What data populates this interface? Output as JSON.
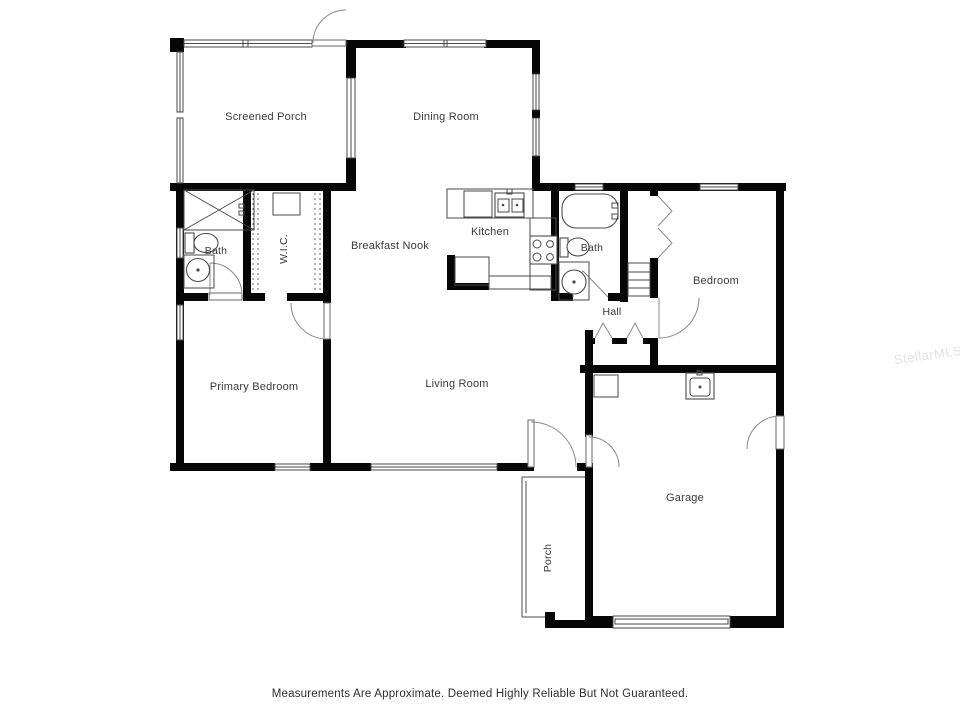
{
  "plan": {
    "rooms": [
      {
        "id": "screened-porch",
        "label": "Screened Porch"
      },
      {
        "id": "dining-room",
        "label": "Dining Room"
      },
      {
        "id": "breakfast-nook",
        "label": "Breakfast Nook"
      },
      {
        "id": "kitchen",
        "label": "Kitchen"
      },
      {
        "id": "bath-1",
        "label": "Bath"
      },
      {
        "id": "wic",
        "label": "W.I.C."
      },
      {
        "id": "bath-2",
        "label": "Bath"
      },
      {
        "id": "bedroom",
        "label": "Bedroom"
      },
      {
        "id": "hall",
        "label": "Hall"
      },
      {
        "id": "primary-bedroom",
        "label": "Primary Bedroom"
      },
      {
        "id": "living-room",
        "label": "Living Room"
      },
      {
        "id": "garage",
        "label": "Garage"
      },
      {
        "id": "porch",
        "label": "Porch"
      }
    ],
    "colors": {
      "wall": "#060606",
      "fixture_line": "#4a4a4a",
      "label_text": "#3a3a3a",
      "watermark": "#aaaaaa"
    }
  },
  "footer": {
    "disclaimer": "Measurements Are Approximate. Deemed Highly Reliable But Not Guaranteed."
  },
  "watermark": {
    "text": "StellarMLS"
  }
}
